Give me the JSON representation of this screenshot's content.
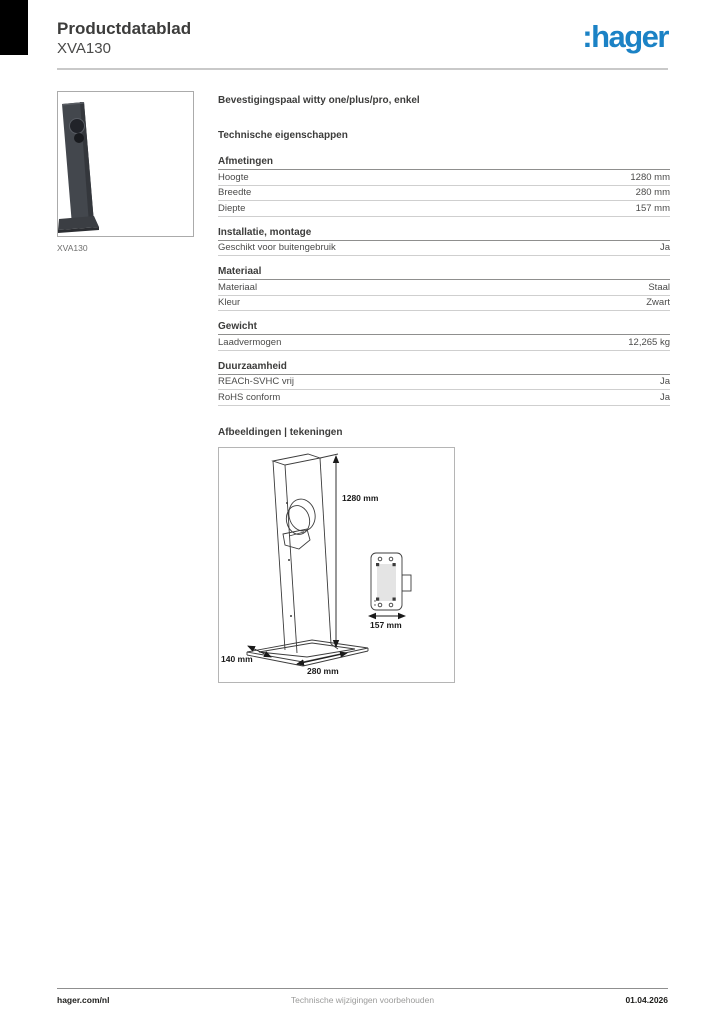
{
  "header": {
    "title": "Productdatablad",
    "subtitle": "XVA130",
    "logo_text": ":hager"
  },
  "product": {
    "name": "Bevestigingspaal witty one/plus/pro, enkel",
    "image_caption": "XVA130"
  },
  "tech": {
    "title": "Technische eigenschappen"
  },
  "specs": [
    {
      "title": "Afmetingen",
      "rows": [
        {
          "label": "Hoogte",
          "value": "1280 mm"
        },
        {
          "label": "Breedte",
          "value": "280 mm"
        },
        {
          "label": "Diepte",
          "value": "157 mm"
        }
      ]
    },
    {
      "title": "Installatie, montage",
      "rows": [
        {
          "label": "Geschikt voor buitengebruik",
          "value": "Ja"
        }
      ]
    },
    {
      "title": "Materiaal",
      "rows": [
        {
          "label": "Materiaal",
          "value": "Staal"
        },
        {
          "label": "Kleur",
          "value": "Zwart"
        }
      ]
    },
    {
      "title": "Gewicht",
      "rows": [
        {
          "label": "Laadvermogen",
          "value": "12,265 kg"
        }
      ]
    },
    {
      "title": "Duurzaamheid",
      "rows": [
        {
          "label": "REACh-SVHC vrij",
          "value": "Ja"
        },
        {
          "label": "RoHS conform",
          "value": "Ja"
        }
      ]
    }
  ],
  "drawings": {
    "title": "Afbeeldingen | tekeningen",
    "labels": {
      "height": "1280 mm",
      "base_depth": "140 mm",
      "base_width": "280 mm",
      "plate_width": "157 mm"
    }
  },
  "footer": {
    "left": "hager.com/nl",
    "center": "Technische wijzigingen voorbehouden",
    "right": "01.04.2026"
  },
  "colors": {
    "brand_blue": "#1b82c5",
    "text_dark": "#3c3c3b"
  }
}
